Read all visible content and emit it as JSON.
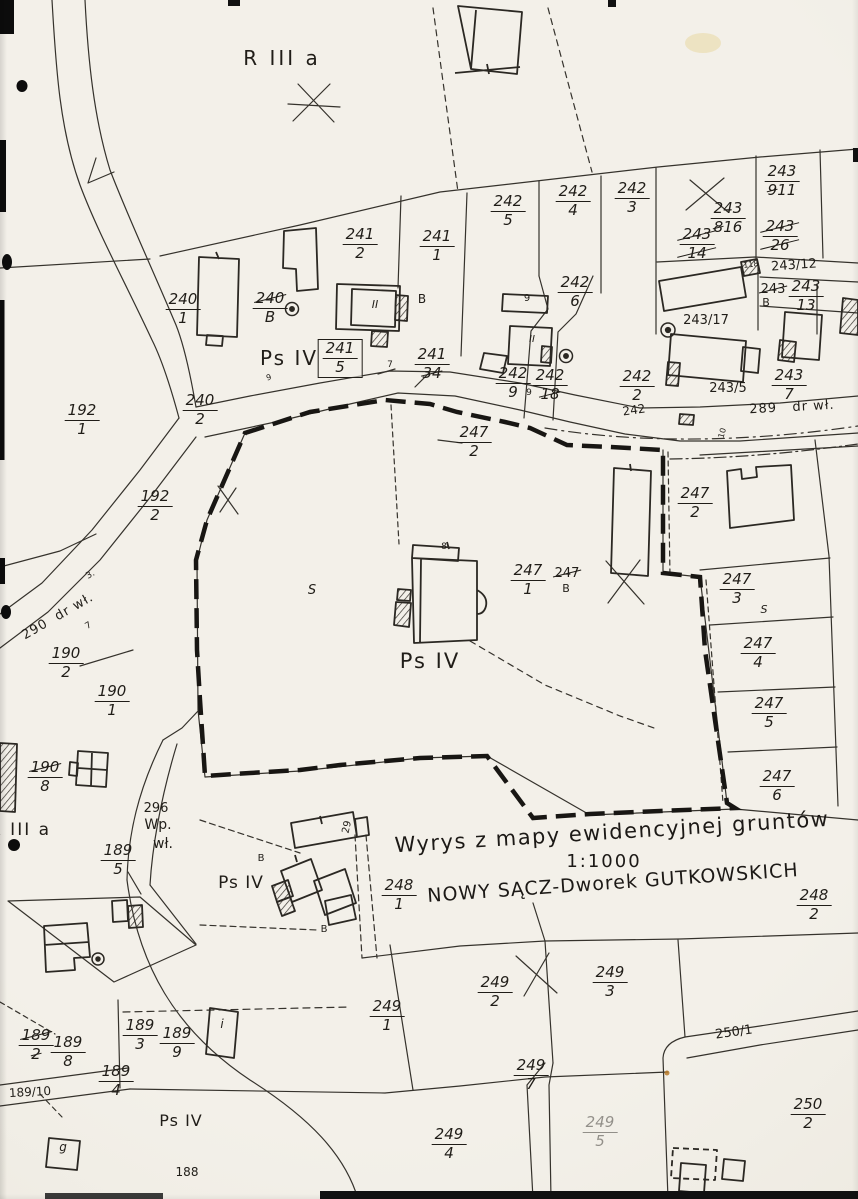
{
  "document": {
    "type_label": "Wyrys z mapy ewidencyjnej gruntów",
    "scale": "1:1000",
    "location": "NOWY SĄCZ-Dworek GUTKOWSKICH"
  },
  "labels": [
    {
      "kind": "text",
      "name": "soil-class-r3a-top",
      "text": "R III a",
      "x": 282,
      "y": 48,
      "size": 20,
      "spacing": 3
    },
    {
      "kind": "frac",
      "name": "parcel-240-1",
      "num": "240",
      "den": "1",
      "x": 183,
      "y": 292
    },
    {
      "kind": "frac",
      "name": "parcel-241-2",
      "num": "241",
      "den": "2",
      "x": 360,
      "y": 227
    },
    {
      "kind": "frac",
      "name": "parcel-241-1",
      "num": "241",
      "den": "1",
      "x": 437,
      "y": 229
    },
    {
      "kind": "frac",
      "name": "parcel-242-5",
      "num": "242",
      "den": "5",
      "x": 508,
      "y": 194
    },
    {
      "kind": "frac",
      "name": "parcel-242-4",
      "num": "242",
      "den": "4",
      "x": 573,
      "y": 184
    },
    {
      "kind": "frac",
      "name": "parcel-242-3",
      "num": "242",
      "den": "3",
      "x": 632,
      "y": 181
    },
    {
      "kind": "frac",
      "name": "parcel-242-6",
      "num": "242",
      "den": "6",
      "x": 575,
      "y": 275
    },
    {
      "kind": "frac",
      "name": "parcel-243-9-renum-11",
      "num": "243",
      "den_parts": [
        [
          "9",
          true
        ],
        [
          "11",
          false
        ]
      ],
      "x": 782,
      "y": 164
    },
    {
      "kind": "frac",
      "name": "parcel-243-8-renum-16",
      "num": "243",
      "den_parts": [
        [
          "8",
          true
        ],
        [
          "16",
          false
        ]
      ],
      "x": 728,
      "y": 201
    },
    {
      "kind": "frac",
      "name": "parcel-243-14-struck",
      "num": "243",
      "den": "14",
      "struck": "all",
      "x": 697,
      "y": 227
    },
    {
      "kind": "frac",
      "name": "parcel-243-26-struck",
      "num": "243",
      "den": "26",
      "struck": "all",
      "x": 780,
      "y": 219
    },
    {
      "kind": "text",
      "name": "parcel-243-12",
      "text": "243/12",
      "x": 794,
      "y": 259,
      "size": 13,
      "rot": -4
    },
    {
      "kind": "text",
      "name": "mark-118",
      "text": "118",
      "x": 751,
      "y": 261,
      "size": 8,
      "rot": -8
    },
    {
      "kind": "text",
      "name": "parcel-243-struck",
      "text": "243",
      "struck": "all",
      "x": 773,
      "y": 283,
      "size": 13
    },
    {
      "kind": "text",
      "name": "building-mark-b-243",
      "text": "B",
      "x": 766,
      "y": 297,
      "size": 11
    },
    {
      "kind": "frac",
      "name": "parcel-243-13",
      "num": "243",
      "den": "13",
      "x": 806,
      "y": 279
    },
    {
      "kind": "text",
      "name": "parcel-243-17",
      "text": "243/17",
      "x": 706,
      "y": 314,
      "size": 13
    },
    {
      "kind": "text",
      "name": "parcel-243-5",
      "text": "243/5",
      "x": 728,
      "y": 382,
      "size": 13
    },
    {
      "kind": "frac",
      "name": "parcel-243-7",
      "num": "243",
      "den": "7",
      "x": 789,
      "y": 368
    },
    {
      "kind": "text",
      "name": "road-label-289",
      "text": "289   dr wł.",
      "x": 792,
      "y": 401,
      "size": 13,
      "rot": -3,
      "spacing": 1
    },
    {
      "kind": "frac",
      "name": "parcel-242-2",
      "num": "242",
      "den": "2",
      "x": 637,
      "y": 369
    },
    {
      "kind": "text",
      "name": "road-parcel-242",
      "text": "242",
      "x": 634,
      "y": 404,
      "size": 12,
      "rot": -8
    },
    {
      "kind": "frac",
      "name": "parcel-241-5",
      "num": "241",
      "den": "5",
      "x": 340,
      "y": 339,
      "box": true
    },
    {
      "kind": "frac",
      "name": "parcel-241-34-struck",
      "num": "241",
      "den_parts": [
        [
          "34",
          true
        ]
      ],
      "x": 432,
      "y": 347
    },
    {
      "kind": "frac",
      "name": "parcel-242-9",
      "num": "242",
      "den": "9",
      "x": 513,
      "y": 366
    },
    {
      "kind": "text",
      "name": "point-mark-9",
      "text": "9",
      "x": 529,
      "y": 389,
      "size": 9
    },
    {
      "kind": "frac",
      "name": "parcel-242-18-struck",
      "num": "242",
      "den_parts": [
        [
          "18",
          true
        ]
      ],
      "x": 550,
      "y": 368
    },
    {
      "kind": "frac",
      "name": "parcel-240-2",
      "num": "240",
      "den": "2",
      "x": 200,
      "y": 393
    },
    {
      "kind": "frac",
      "name": "parcel-192-1",
      "num": "192",
      "den": "1",
      "x": 82,
      "y": 403
    },
    {
      "kind": "frac",
      "name": "parcel-192-2",
      "num": "192",
      "den": "2",
      "x": 155,
      "y": 489
    },
    {
      "kind": "text",
      "name": "road-label-290",
      "text": "290  dr wł.",
      "x": 58,
      "y": 610,
      "size": 13,
      "rot": -30,
      "spacing": 1
    },
    {
      "kind": "text",
      "name": "tick-label-3",
      "text": "3.",
      "x": 91,
      "y": 571,
      "size": 9,
      "rot": -30
    },
    {
      "kind": "text",
      "name": "tick-label-7-sw",
      "text": "7",
      "x": 89,
      "y": 622,
      "size": 9,
      "rot": -30
    },
    {
      "kind": "frac",
      "name": "parcel-190-2",
      "num": "190",
      "den": "2",
      "x": 66,
      "y": 646
    },
    {
      "kind": "frac",
      "name": "parcel-190-1",
      "num": "190",
      "den": "1",
      "x": 112,
      "y": 684
    },
    {
      "kind": "frac",
      "name": "parcel-190-8-struck",
      "num_parts": [
        [
          "190",
          true
        ]
      ],
      "den": "8",
      "x": 45,
      "y": 760
    },
    {
      "kind": "frac",
      "name": "parcel-240-8-struck",
      "num_parts": [
        [
          "240",
          true
        ]
      ],
      "den": "B",
      "x": 270,
      "y": 291
    },
    {
      "kind": "text",
      "name": "building-mark-b-241",
      "text": "B",
      "x": 422,
      "y": 293,
      "size": 12
    },
    {
      "kind": "text",
      "name": "storeys-mark-241",
      "text": "II",
      "x": 375,
      "y": 299,
      "size": 11,
      "italic": true
    },
    {
      "kind": "text",
      "name": "building-mark-9",
      "text": "9",
      "x": 527,
      "y": 294,
      "size": 10
    },
    {
      "kind": "text",
      "name": "storeys-mark-242",
      "text": "II",
      "x": 532,
      "y": 335,
      "size": 10,
      "italic": true
    },
    {
      "kind": "frac",
      "name": "parcel-247-2-west",
      "num": "247",
      "den": "2",
      "x": 474,
      "y": 425
    },
    {
      "kind": "frac",
      "name": "parcel-247-2-east",
      "num": "247",
      "den": "2",
      "x": 695,
      "y": 486
    },
    {
      "kind": "frac",
      "name": "parcel-247-1",
      "num": "247",
      "den": "1",
      "x": 528,
      "y": 563
    },
    {
      "kind": "text",
      "name": "parcel-247-struck",
      "text": "247",
      "struck": "all",
      "x": 567,
      "y": 567,
      "size": 13
    },
    {
      "kind": "text",
      "name": "building-mark-b-247",
      "text": "B",
      "x": 566,
      "y": 583,
      "size": 11
    },
    {
      "kind": "text",
      "name": "building-mark-8",
      "text": "8",
      "x": 444,
      "y": 543,
      "size": 9
    },
    {
      "kind": "text",
      "name": "land-use-s-mid",
      "text": "S",
      "x": 312,
      "y": 584,
      "size": 13,
      "italic": true
    },
    {
      "kind": "text",
      "name": "soil-class-psiv-top",
      "text": "Ps IV",
      "x": 289,
      "y": 348,
      "size": 20,
      "spacing": 2
    },
    {
      "kind": "text",
      "name": "soil-class-psiv-mid",
      "text": "Ps IV",
      "x": 430,
      "y": 650,
      "size": 21,
      "spacing": 2
    },
    {
      "kind": "frac",
      "name": "parcel-247-3",
      "num": "247",
      "den": "3",
      "x": 737,
      "y": 572
    },
    {
      "kind": "text",
      "name": "land-use-s-right",
      "text": "S",
      "x": 764,
      "y": 604,
      "size": 11,
      "italic": true
    },
    {
      "kind": "frac",
      "name": "parcel-247-4",
      "num": "247",
      "den": "4",
      "x": 758,
      "y": 636
    },
    {
      "kind": "frac",
      "name": "parcel-247-5",
      "num": "247",
      "den": "5",
      "x": 769,
      "y": 696
    },
    {
      "kind": "frac",
      "name": "parcel-247-6",
      "num": "247",
      "den": "6",
      "x": 777,
      "y": 769
    },
    {
      "kind": "text",
      "name": "soil-class-r3a-left",
      "text": "R III a",
      "x": 20,
      "y": 822,
      "size": 17,
      "spacing": 2
    },
    {
      "kind": "text",
      "name": "parcel-296",
      "text": "296",
      "x": 156,
      "y": 802,
      "size": 13
    },
    {
      "kind": "text",
      "name": "land-use-wp",
      "text": "Wp.",
      "x": 158,
      "y": 818,
      "size": 14
    },
    {
      "kind": "text",
      "name": "land-use-wl",
      "text": "wł.",
      "x": 163,
      "y": 837,
      "size": 14
    },
    {
      "kind": "frac",
      "name": "parcel-189-5",
      "num": "189",
      "den": "5",
      "x": 118,
      "y": 843
    },
    {
      "kind": "text",
      "name": "soil-class-psiv-farm",
      "text": "Ps IV",
      "x": 241,
      "y": 875,
      "size": 17,
      "spacing": 1
    },
    {
      "kind": "text",
      "name": "building-mark-b-farm-top",
      "text": "B",
      "x": 261,
      "y": 854,
      "size": 10
    },
    {
      "kind": "text",
      "name": "building-number-29",
      "text": "29",
      "x": 348,
      "y": 822,
      "size": 10,
      "rot": -78
    },
    {
      "kind": "frac",
      "name": "parcel-248-1",
      "num": "248",
      "den": "1",
      "x": 399,
      "y": 878
    },
    {
      "kind": "text",
      "name": "building-mark-b-farm-bottom",
      "text": "B",
      "x": 324,
      "y": 925,
      "size": 10
    },
    {
      "kind": "frac",
      "name": "parcel-248-2",
      "num": "248",
      "den": "2",
      "x": 814,
      "y": 888
    },
    {
      "kind": "frac",
      "name": "parcel-249-1",
      "num": "249",
      "den": "1",
      "x": 387,
      "y": 999
    },
    {
      "kind": "frac",
      "name": "parcel-249-2",
      "num": "249",
      "den": "2",
      "x": 495,
      "y": 975
    },
    {
      "kind": "frac",
      "name": "parcel-249-3",
      "num": "249",
      "den": "3",
      "x": 610,
      "y": 965
    },
    {
      "kind": "frac",
      "name": "parcel-249-7",
      "num": "249",
      "den": "7",
      "x": 531,
      "y": 1058
    },
    {
      "kind": "frac",
      "name": "parcel-249-4",
      "num": "249",
      "den": "4",
      "x": 449,
      "y": 1127
    },
    {
      "kind": "frac",
      "name": "parcel-249-5",
      "num": "249",
      "den": "5",
      "x": 600,
      "y": 1115,
      "faint": true
    },
    {
      "kind": "text",
      "name": "road-parcel-250-1",
      "text": "250/1",
      "x": 734,
      "y": 1026,
      "size": 13,
      "rot": -8
    },
    {
      "kind": "frac",
      "name": "parcel-250-2",
      "num": "250",
      "den": "2",
      "x": 808,
      "y": 1097
    },
    {
      "kind": "frac",
      "name": "parcel-189-2-struck",
      "num_parts": [
        [
          "189",
          true
        ]
      ],
      "den_parts": [
        [
          "2",
          true
        ]
      ],
      "x": 36,
      "y": 1028
    },
    {
      "kind": "frac",
      "name": "parcel-189-8",
      "num": "189",
      "den": "8",
      "x": 68,
      "y": 1035
    },
    {
      "kind": "frac",
      "name": "parcel-189-3",
      "num": "189",
      "den": "3",
      "x": 140,
      "y": 1018
    },
    {
      "kind": "frac",
      "name": "parcel-189-9",
      "num": "189",
      "den": "9",
      "x": 177,
      "y": 1026
    },
    {
      "kind": "text",
      "name": "building-mark-i",
      "text": "i",
      "x": 222,
      "y": 1018,
      "size": 12,
      "italic": true
    },
    {
      "kind": "frac",
      "name": "parcel-189-4",
      "num": "189",
      "den": "4",
      "x": 116,
      "y": 1064
    },
    {
      "kind": "text",
      "name": "parcel-189-10",
      "text": "189/10",
      "x": 30,
      "y": 1086,
      "size": 12,
      "rot": -3
    },
    {
      "kind": "text",
      "name": "building-mark-g",
      "text": "g",
      "x": 63,
      "y": 1141,
      "size": 12,
      "italic": true
    },
    {
      "kind": "text",
      "name": "soil-class-psiv-bottom",
      "text": "Ps IV",
      "x": 181,
      "y": 1113,
      "size": 16,
      "spacing": 1
    },
    {
      "kind": "text",
      "name": "parcel-188",
      "text": "188",
      "x": 187,
      "y": 1166,
      "size": 12
    },
    {
      "kind": "text",
      "name": "tick-label-7-road",
      "text": "7",
      "x": 390,
      "y": 361,
      "size": 9
    },
    {
      "kind": "text",
      "name": "tick-label-9-road",
      "text": "9",
      "x": 269,
      "y": 374,
      "size": 8,
      "rot": -15
    },
    {
      "kind": "text",
      "name": "tick-label-10-road",
      "text": "10",
      "x": 723,
      "y": 429,
      "size": 8,
      "rot": -75
    }
  ]
}
